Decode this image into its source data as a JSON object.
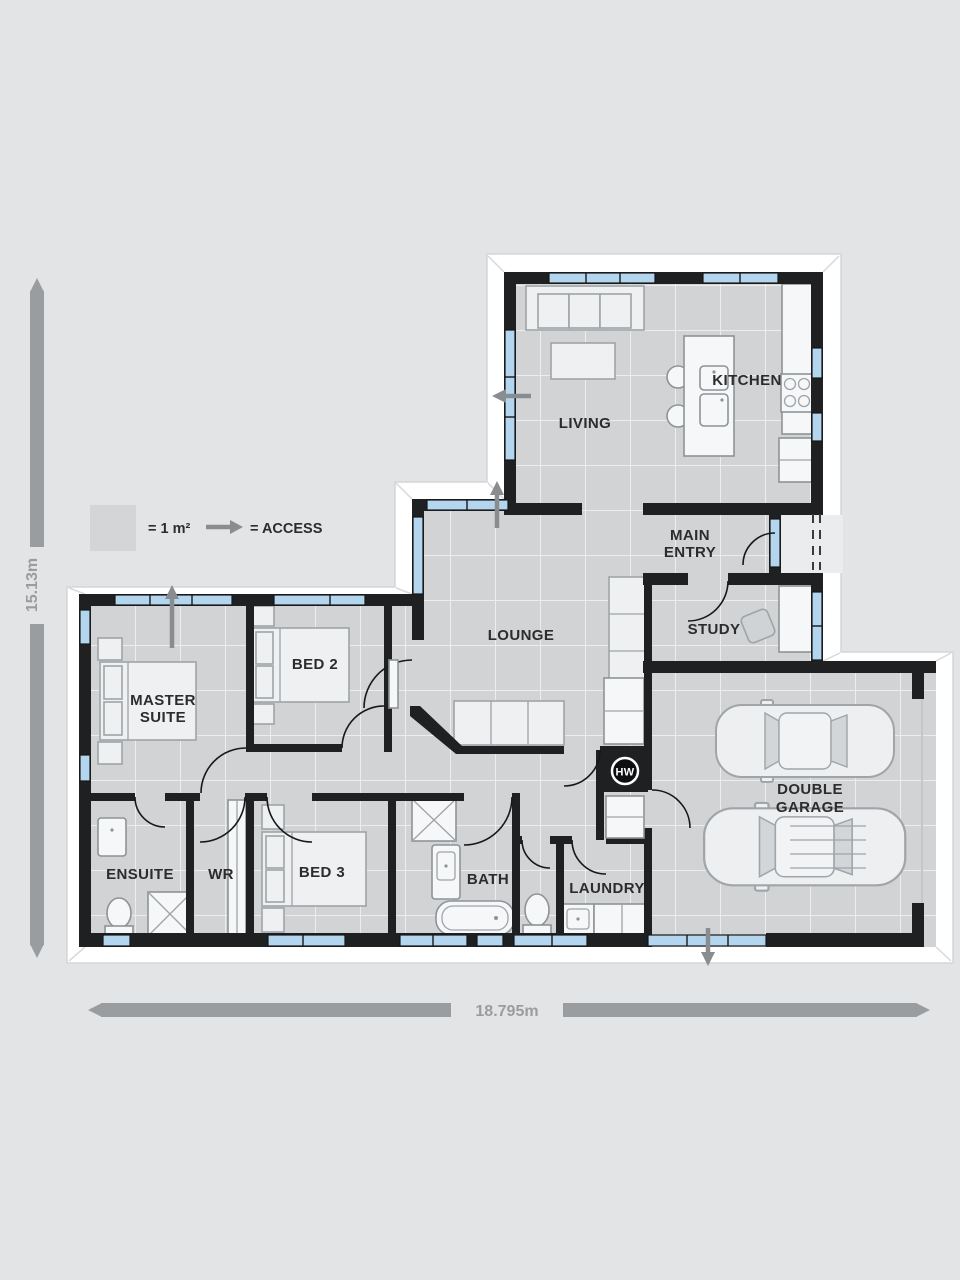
{
  "legend": {
    "area_label": "= 1 m²",
    "access_label": "= ACCESS"
  },
  "dimensions": {
    "vertical": "15.13m",
    "horizontal": "18.795m"
  },
  "rooms": {
    "living": "LIVING",
    "kitchen": "KITCHEN",
    "main_entry": [
      "MAIN",
      "ENTRY"
    ],
    "study": "STUDY",
    "lounge": "LOUNGE",
    "master_suite": [
      "MASTER",
      "SUITE"
    ],
    "bed2": "BED 2",
    "bed3": "BED 3",
    "ensuite": "ENSUITE",
    "wr": "WR",
    "bath": "BATH",
    "laundry": "LAUNDRY",
    "double_garage": [
      "DOUBLE",
      "GARAGE"
    ],
    "hot_water": "HW"
  },
  "colors": {
    "background": "#e3e4e6",
    "wall": "#1f2022",
    "window": "#b3d6ee",
    "floor": "#d2d3d5",
    "grid_line": "#ffffff",
    "outline_band": "#ffffff",
    "dimension": "#9a9da0",
    "access_arrow": "#8a8d90",
    "label": "#2b2c2e"
  }
}
